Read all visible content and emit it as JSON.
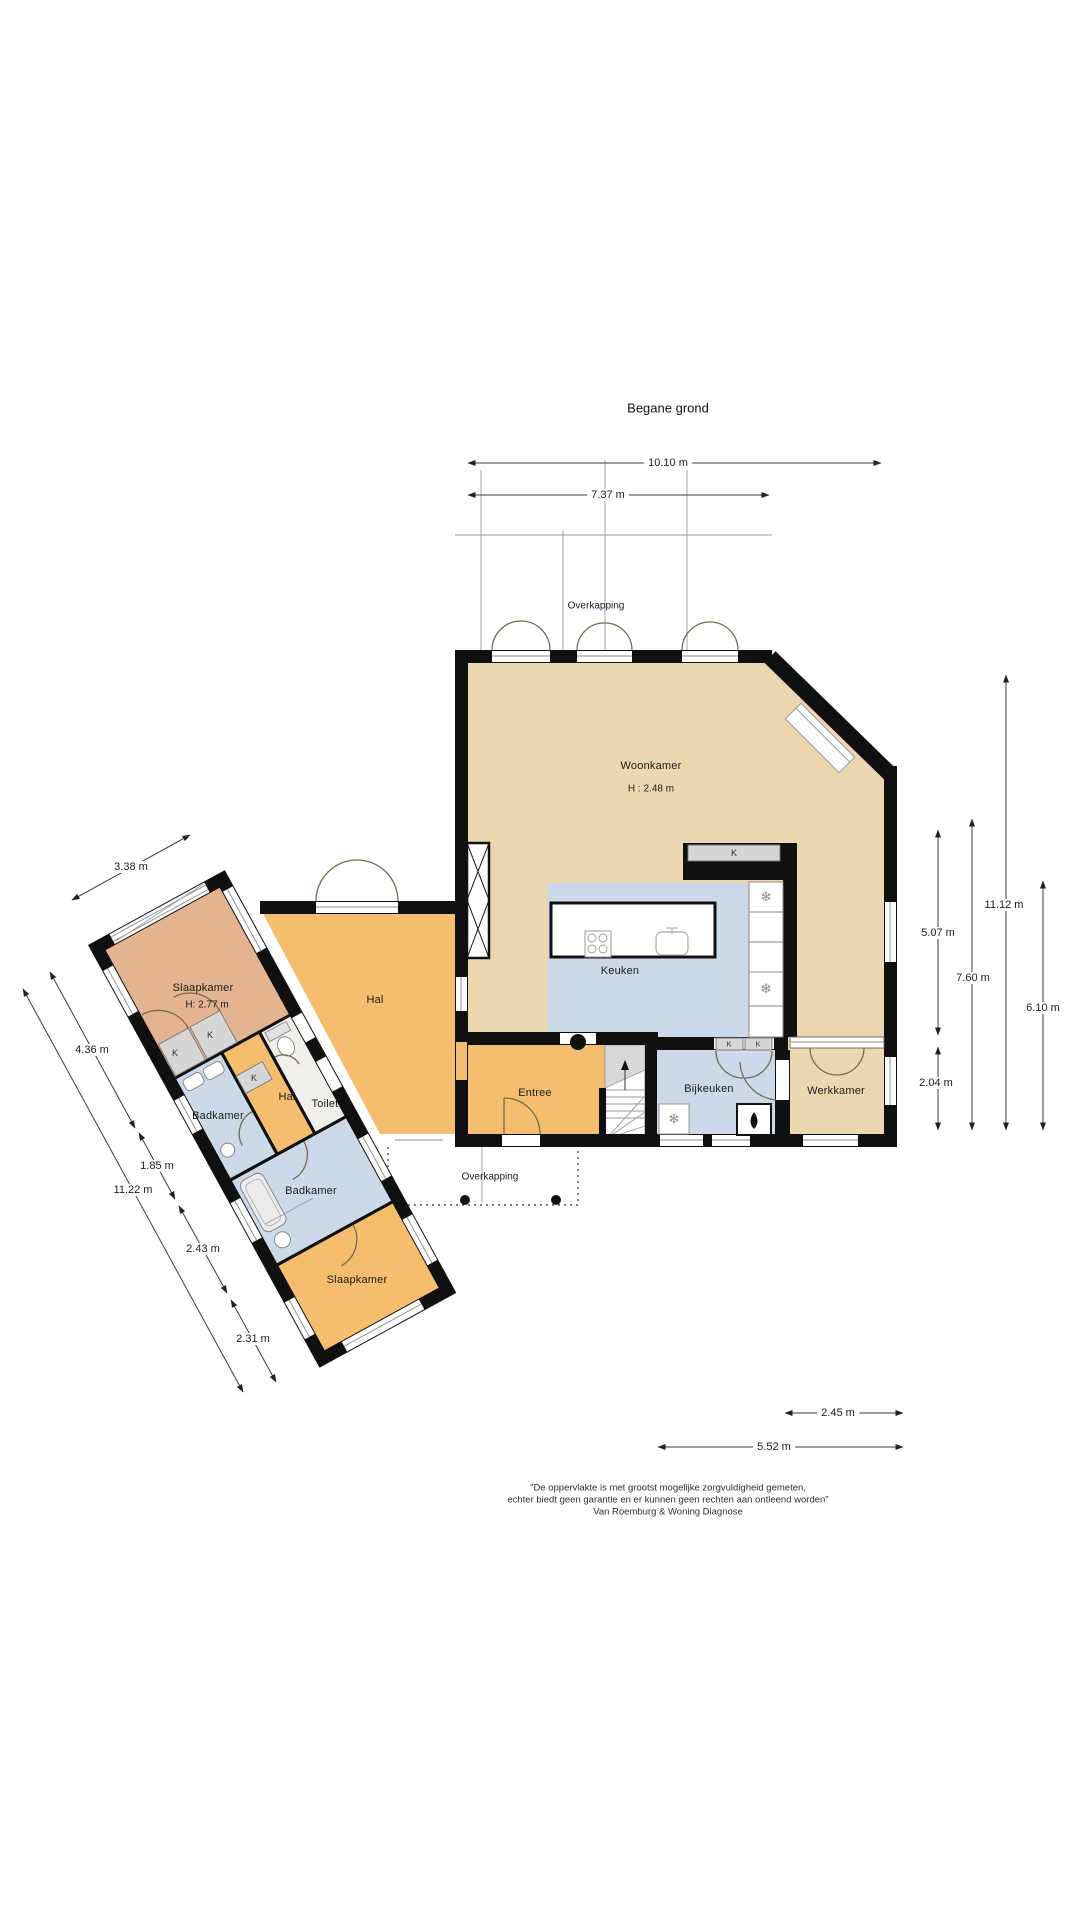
{
  "title": "Begane grond",
  "palette": {
    "wall": "#101010",
    "living_tan": "#ecd8b0",
    "hall_orange": "#f5be6e",
    "wet_blue": "#cbd9e8",
    "bedroom_salmon": "#e3b48f",
    "toilet_gray": "#f0efec"
  },
  "rooms": {
    "woonkamer": {
      "label": "Woonkamer",
      "height": "H : 2.48 m"
    },
    "keuken": {
      "label": "Keuken"
    },
    "bijkeuken": {
      "label": "Bijkeuken"
    },
    "werkkamer": {
      "label": "Werkkamer"
    },
    "entree": {
      "label": "Entree"
    },
    "hal": {
      "label": "Hal"
    },
    "slaapkamer_1": {
      "label": "Slaapkamer",
      "height": "H: 2.77 m"
    },
    "badkamer_1": {
      "label": "Badkamer"
    },
    "hal_wing": {
      "label": "Hal"
    },
    "toilet": {
      "label": "Toilet"
    },
    "badkamer_2": {
      "label": "Badkamer"
    },
    "slaapkamer_2": {
      "label": "Slaapkamer"
    }
  },
  "annotations": {
    "overkapping_top": "Overkapping",
    "overkapping_bottom": "Overkapping",
    "closet": "K"
  },
  "icons": {
    "snowflake": "❄"
  },
  "dims": {
    "d1010": "10.10 m",
    "d737": "7.37 m",
    "d507": "5.07 m",
    "d760": "7.60 m",
    "d1112": "11.12 m",
    "d610": "6.10 m",
    "d204": "2.04 m",
    "d338": "3.38 m",
    "d436": "4.36 m",
    "d185": "1.85 m",
    "d1122": "11.22 m",
    "d243": "2.43 m",
    "d231": "2.31 m",
    "d245": "2.45 m",
    "d552": "5.52 m"
  },
  "footer": {
    "line1": "\"De oppervlakte is met grootst mogelijke zorgvuldigheid gemeten,",
    "line2": "echter biedt geen garantie en er kunnen geen rechten aan ontleend worden\"",
    "line3": "Van Roemburg & Woning Diagnose"
  }
}
